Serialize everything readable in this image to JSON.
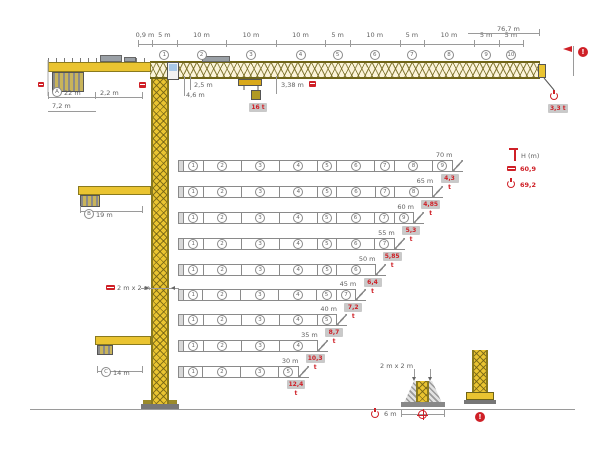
{
  "title": "Tower crane dimensions and jib configurations diagram",
  "colors": {
    "red": "#cf2027",
    "yellow": "#eac431",
    "badge_bg": "#c9c9c9"
  },
  "icons": {
    "alert": "!"
  },
  "jib_dims": {
    "total": "76,7 m",
    "segments": [
      {
        "label": "0,9 m",
        "m": 0.9
      },
      {
        "label": "5 m",
        "m": 5,
        "num": "1"
      },
      {
        "label": "10 m",
        "m": 10,
        "num": "2"
      },
      {
        "label": "10 m",
        "m": 10,
        "num": "3"
      },
      {
        "label": "10 m",
        "m": 10,
        "num": "4"
      },
      {
        "label": "5 m",
        "m": 5,
        "num": "5"
      },
      {
        "label": "10 m",
        "m": 10,
        "num": "6"
      },
      {
        "label": "5 m",
        "m": 5,
        "num": "7"
      },
      {
        "label": "10 m",
        "m": 10,
        "num": "8"
      },
      {
        "label": "5 m",
        "m": 5,
        "num": "9"
      },
      {
        "label": "5 m",
        "m": 5,
        "num": "10"
      }
    ]
  },
  "elevation": {
    "counterjib_radius_id": "A",
    "counterjib_radius": "22 m",
    "rear_width": "2,2 m",
    "rear_height": "7,2 m",
    "jib_depth": "2,5 m",
    "foot_height": "4,6 m",
    "min_radius": "3,38 m",
    "max_load": "16 t",
    "tip_load": "3,3 t"
  },
  "alt_counterjibs": [
    {
      "id": "B",
      "label": "19 m"
    },
    {
      "id": "C",
      "label": "14 m"
    }
  ],
  "mast": {
    "section_label": "2 m x 2 m"
  },
  "legend": {
    "title": "H (m)",
    "entries": [
      {
        "icon": "ballast-slab",
        "value": "60,9"
      },
      {
        "icon": "hook",
        "value": "69,2"
      }
    ]
  },
  "configs": [
    {
      "label": "70 m",
      "sections": [
        "1",
        "2",
        "3",
        "4",
        "5",
        "6",
        "7",
        "8",
        "9"
      ],
      "capacity": "4,3 t"
    },
    {
      "label": "65 m",
      "sections": [
        "1",
        "2",
        "3",
        "4",
        "5",
        "6",
        "7",
        "8"
      ],
      "capacity": "4,85 t"
    },
    {
      "label": "60 m",
      "sections": [
        "1",
        "2",
        "3",
        "4",
        "5",
        "6",
        "7",
        "9"
      ],
      "capacity": "5,3 t"
    },
    {
      "label": "55 m",
      "sections": [
        "1",
        "2",
        "3",
        "4",
        "5",
        "6",
        "7"
      ],
      "capacity": "5,85 t"
    },
    {
      "label": "50 m",
      "sections": [
        "1",
        "2",
        "3",
        "4",
        "5",
        "6"
      ],
      "capacity": "6,4 t"
    },
    {
      "label": "45 m",
      "sections": [
        "1",
        "2",
        "3",
        "4",
        "5",
        "7"
      ],
      "capacity": "7,2 t"
    },
    {
      "label": "40 m",
      "sections": [
        "1",
        "2",
        "3",
        "4",
        "5"
      ],
      "capacity": "8,7 t"
    },
    {
      "label": "35 m",
      "sections": [
        "1",
        "2",
        "3",
        "4"
      ],
      "capacity": "10,3 t"
    },
    {
      "label": "30 m",
      "sections": [
        "1",
        "2",
        "3",
        "5"
      ],
      "capacity": "12,4 t"
    }
  ],
  "base": {
    "mast_label": "2 m x 2 m",
    "span": "6 m"
  }
}
